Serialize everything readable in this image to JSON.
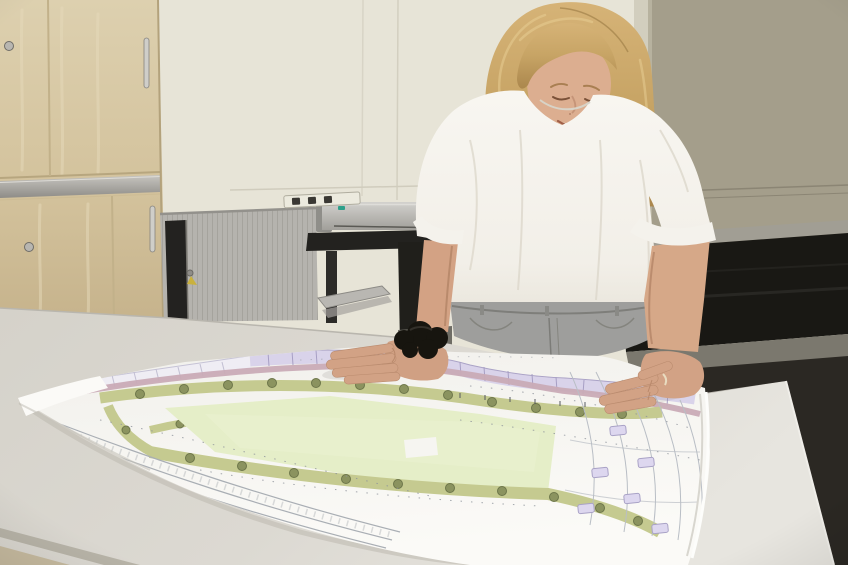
{
  "meta": {
    "type": "photograph",
    "width": 848,
    "height": 565
  },
  "scene": {
    "caption": "Young woman studying a large-format landscape site plan spread on a white table",
    "description": "A young woman with shoulder-length blonde hair, wearing a white t-shirt and grey jeans, leans over a white table with both hands resting on a large printed architectural site plan in an office. Behind her are a maple sliding-door cabinet, a grey tambour cabinet with a key in its lock, a large-format plotter on a black stand, and a long dark sideboard against a beige wall.",
    "objects": {
      "woman": "young woman, blonde shoulder-length hair, white t-shirt, grey jeans, black scrunchie on left wrist, ring on right hand",
      "site_plan": "large-format site plan: light green sports field, olive planting strips with trees, lilac building footprints and dusty-pink path along the top edge, road and parking line work at right, paper curled at edges",
      "table": "white meeting table",
      "wooden_cabinet": "light maple office cabinet, two stacked sliding-door units with silver trim strip",
      "roller_cabinet": "grey tambour (roller shutter) cabinet with key and yellow tag in lock",
      "plotter": "large-format printer on black stand with paper tray",
      "power_strip": "white power strip mounted on wall",
      "sideboard": "long dark sideboard along right wall",
      "walls": "cream wall at left, darker khaki-beige wall at right",
      "floor": "dark floor beyond table right edge, beige floor at lower-left corner"
    }
  },
  "palette": {
    "wall_left": "#e7e4d7",
    "wall_right": "#a49e8b",
    "cabinet_wood": "#d6c6a2",
    "roller_grey": "#b4b2ad",
    "table": "#d9d6cf",
    "paper": "#f3f2ee",
    "plan_field_green": "#e5eec8",
    "plan_strip_olive": "#c5ca90",
    "plan_tree": "#8b935f",
    "plan_building_lilac": "#d9d3ea",
    "plan_path_pink": "#c9abb6",
    "hair_blonde": "#c7a465",
    "skin": "#d3a588",
    "tshirt": "#f4f2ec",
    "jeans_grey": "#9e9e9c",
    "scrunchie_black": "#17150f",
    "sideboard_black": "#191814",
    "floor_dark": "#2b2823"
  }
}
